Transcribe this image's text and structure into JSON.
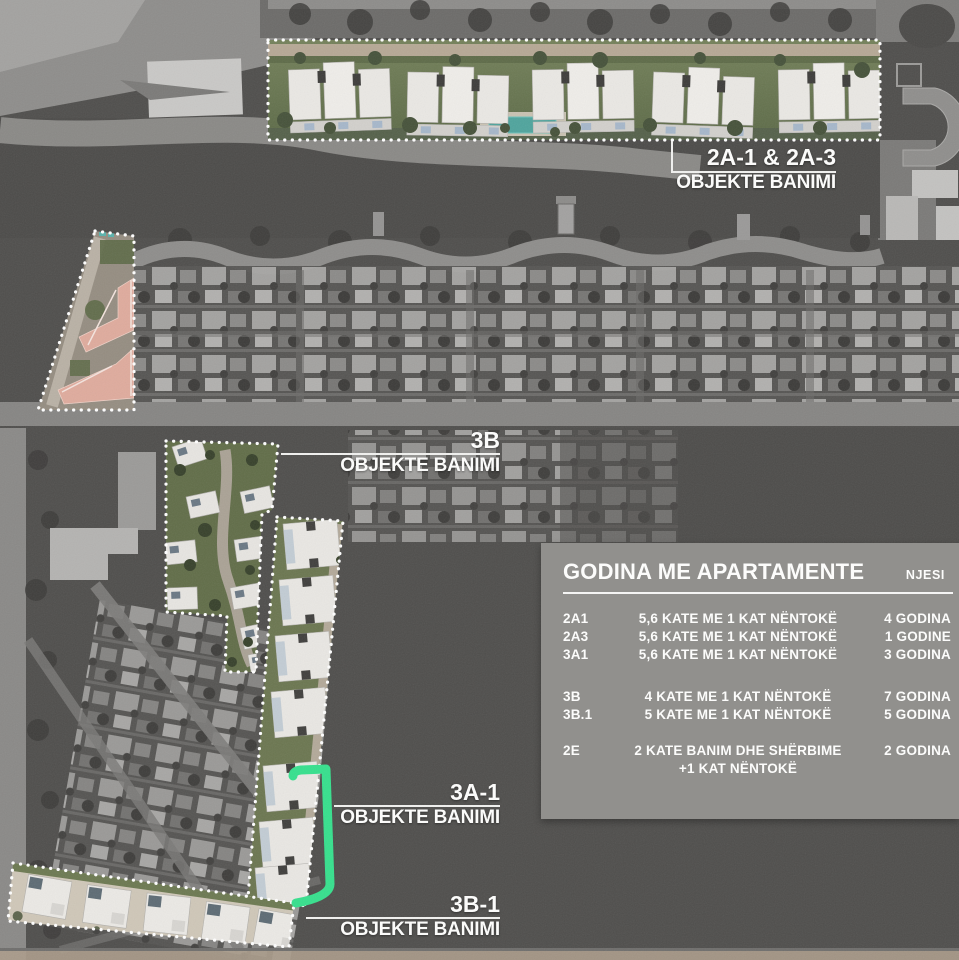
{
  "callouts": {
    "area_2a": {
      "code": "2A-1 & 2A-3",
      "type": "OBJEKTE BANIMI"
    },
    "area_3b": {
      "code": "3B",
      "type": "OBJEKTE BANIMI"
    },
    "area_3a1": {
      "code": "3A-1",
      "type": "OBJEKTE BANIMI"
    },
    "area_3b1": {
      "code": "3B-1",
      "type": "OBJEKTE BANIMI"
    }
  },
  "legend": {
    "title": "GODINA ME APARTAMENTE",
    "units_header": "NJESI",
    "rows": [
      {
        "code": "2A1",
        "description": "5,6 KATE ME 1 KAT NËNTOKË",
        "units": "4 GODINA"
      },
      {
        "code": "2A3",
        "description": "5,6 KATE ME 1 KAT NËNTOKË",
        "units": "1 GODINE"
      },
      {
        "code": "3A1",
        "description": "5,6 KATE ME 1 KAT NËNTOKË",
        "units": "3 GODINA"
      },
      {
        "code": "3B",
        "description": "4 KATE ME 1 KAT NËNTOKË",
        "units": "7 GODINA"
      },
      {
        "code": "3B.1",
        "description": "5 KATE ME 1 KAT NËNTOKË",
        "units": "5 GODINA"
      },
      {
        "code": "2E",
        "description": "2 KATE BANIM DHE SHËRBIME",
        "description_line2": "+1 KAT NËNTOKË",
        "units": "2 GODINA"
      }
    ]
  },
  "colors": {
    "highlight_outline": "#ffffff",
    "highlight_bracket_green": "#36e08d",
    "pool_teal": "#4fa49d",
    "pink_buildings": "#dfab9d",
    "legend_panel": "#94938f"
  }
}
